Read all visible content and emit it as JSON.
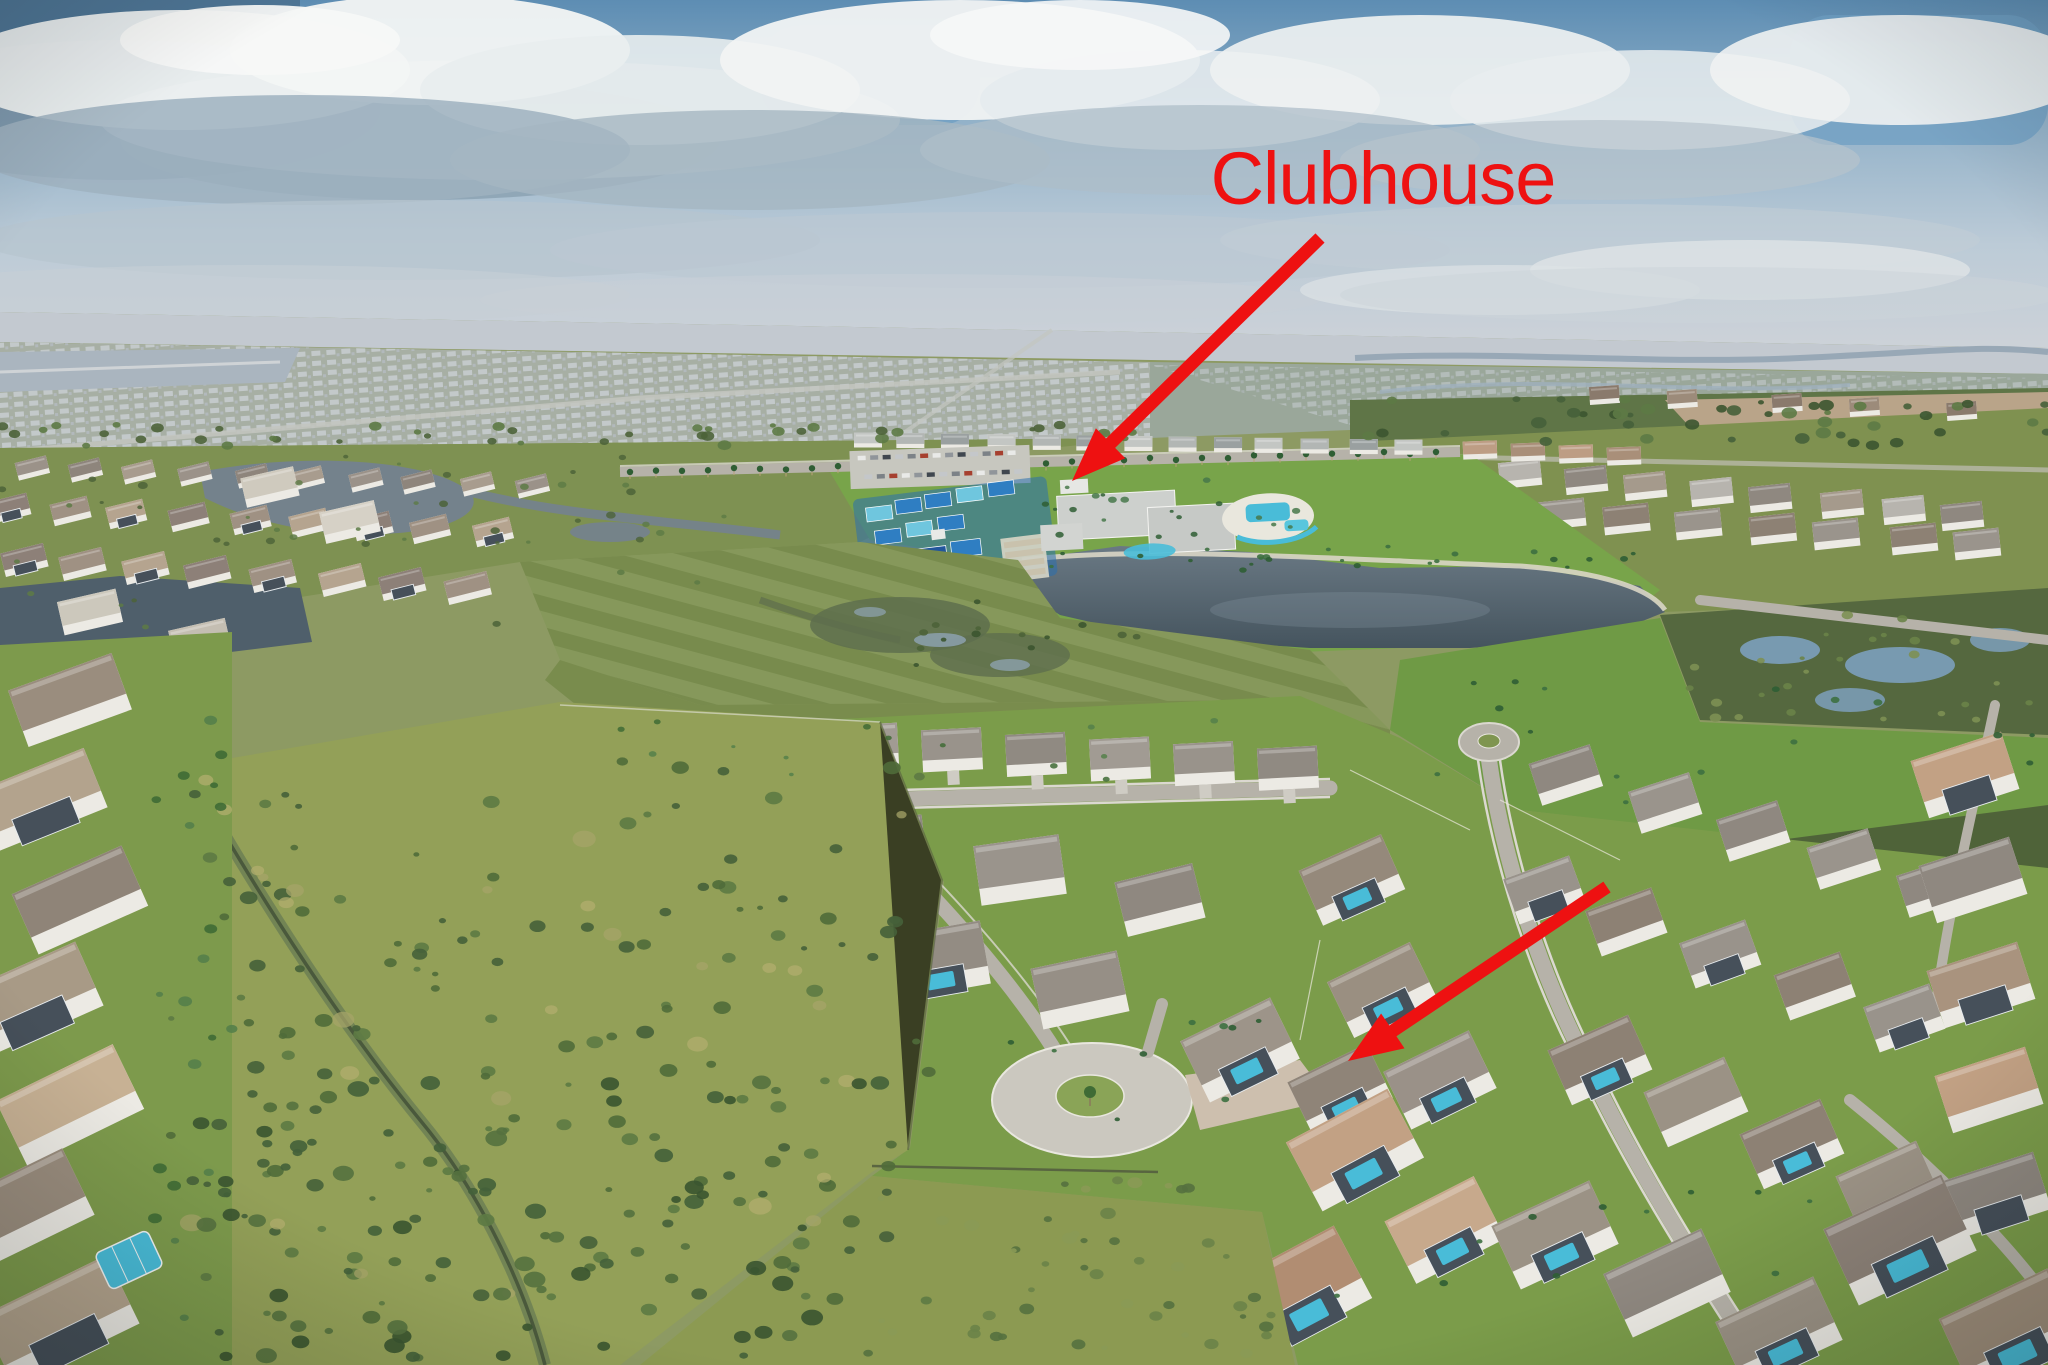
{
  "annotation": {
    "label": "Clubhouse",
    "color": "#ee1111",
    "font_size_px": 74,
    "label_x": 1383,
    "label_y": 204,
    "arrows": [
      {
        "tail_x": 1320,
        "tail_y": 238,
        "tip_x": 1072,
        "tip_y": 481
      },
      {
        "tail_x": 1607,
        "tail_y": 887,
        "tip_x": 1348,
        "tip_y": 1061
      }
    ]
  },
  "palette": {
    "sky_deep": "#4e7595",
    "sky_blue": "#6f9fc3",
    "cloud_white": "#eef1f1",
    "cloud_gray": "#9fb2c0",
    "cloud_slate": "#7b95a8",
    "haze": "#c3c9d0",
    "distant_suburb": "#a7afa4",
    "field_green": "#7e9251",
    "lawn_green": "#7b9c4a",
    "bright_lawn": "#6f9a45",
    "scrub_olive": "#93a058",
    "bush_green": "#4e6a38",
    "tree_green": "#5d7a45",
    "lake_dark": "#4a5a66",
    "pond_blue": "#7fa3c4",
    "marsh_green": "#55683f",
    "court_blue": "#2f7ec2",
    "court_aqua": "#6fc6de",
    "court_navy": "#22569c",
    "pool_aqua": "#49bcd8",
    "roof_gray": "#98928a",
    "roof_brown": "#8d7f72",
    "roof_tan": "#c2a184",
    "roof_light": "#cdd0cd",
    "wall_white": "#eceae4",
    "road_gray": "#b6b2a9",
    "sidewalk": "#dbd8d0",
    "paver_tan": "#cdbfae",
    "dirt_tan": "#b9a489",
    "shore_sand": "#d9d6c5",
    "lanai_dark": "#46505a",
    "water_glint": "#8fa4b4"
  }
}
